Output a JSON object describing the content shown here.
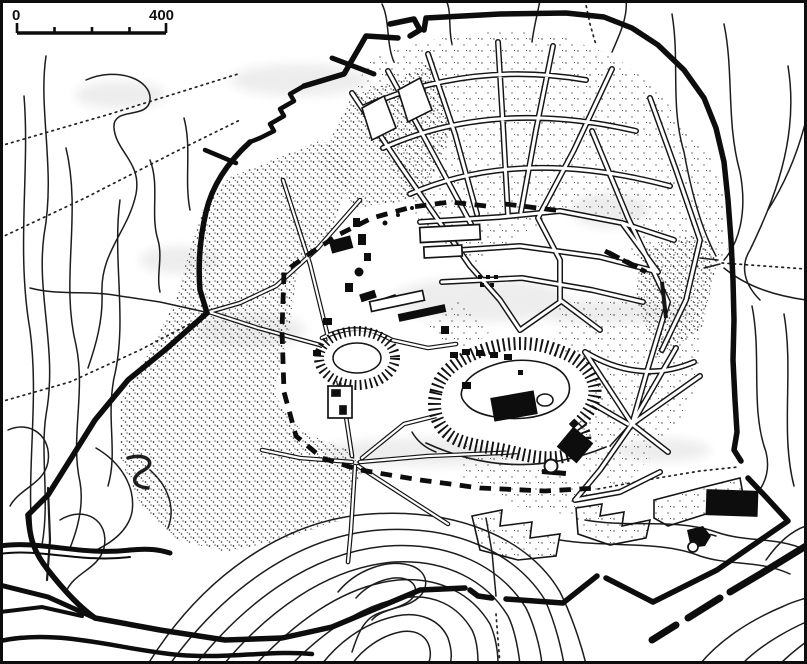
{
  "scale_bar": {
    "zero_label": "0",
    "end_label": "400"
  },
  "colors": {
    "ink": "#141414",
    "contour": "#1c1c1c",
    "paper": "#ffffff",
    "halo": "#ededed"
  }
}
